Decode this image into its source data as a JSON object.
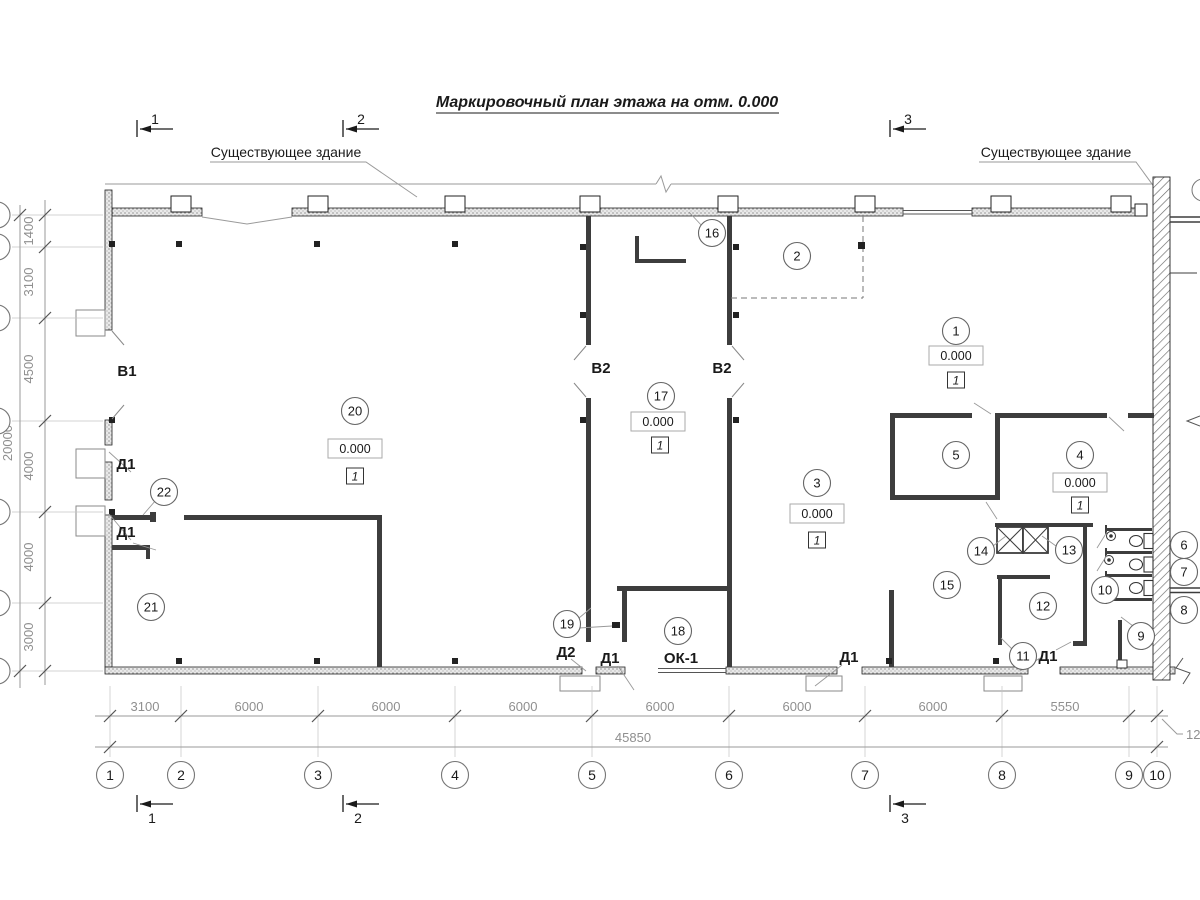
{
  "title": "Маркировочный план этажа на отм. 0.000",
  "annotations": {
    "existing_building": "Существующее здание",
    "elevation_mark": "0.000",
    "floor_type_mark": "1"
  },
  "section_marks": [
    "1",
    "2",
    "3"
  ],
  "door_window_labels": {
    "v1": "В1",
    "v2": "В2",
    "d1": "Д1",
    "d2": "Д2",
    "ok1": "ОК-1"
  },
  "rooms": [
    "1",
    "2",
    "3",
    "4",
    "5",
    "6",
    "7",
    "8",
    "9",
    "10",
    "11",
    "12",
    "13",
    "14",
    "15",
    "16",
    "17",
    "18",
    "19",
    "20",
    "21",
    "22"
  ],
  "grid": {
    "columns": [
      "1",
      "2",
      "3",
      "4",
      "5",
      "6",
      "7",
      "8",
      "9",
      "10"
    ],
    "bottom_dims": [
      "3100",
      "6000",
      "6000",
      "6000",
      "6000",
      "6000",
      "6000",
      "5550"
    ],
    "bottom_dim_cut": "120",
    "bottom_total": "45850",
    "left_dims": [
      "1400",
      "3100",
      "4500",
      "4000",
      "4000",
      "3000"
    ],
    "left_total": "20000"
  },
  "colors": {
    "wall": "#3d3d3d",
    "dim": "#8f8f8f",
    "line": "#1a1a1a"
  }
}
